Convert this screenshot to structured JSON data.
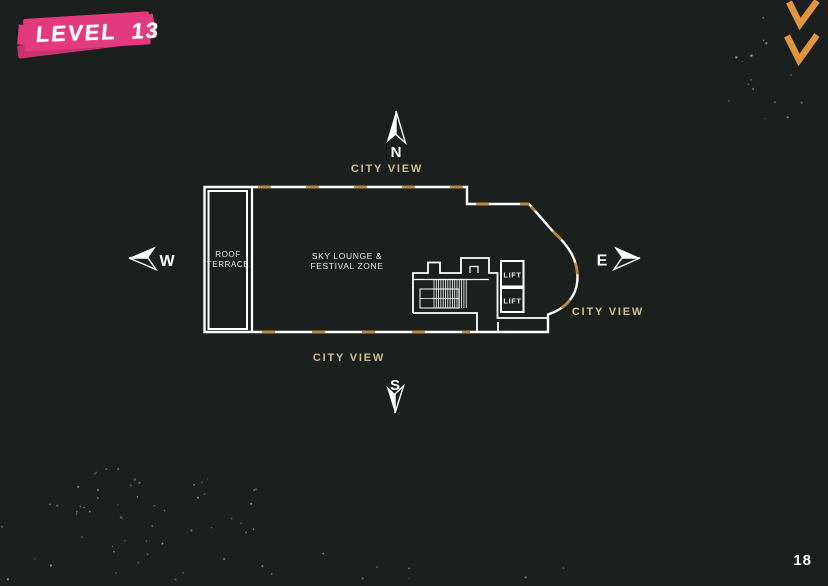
{
  "title": {
    "label": "LEVEL 13"
  },
  "page_number": "18",
  "compass": {
    "north": "N",
    "south": "S",
    "east": "E",
    "west": "W"
  },
  "views": {
    "city_view_top": "CITY VIEW",
    "city_view_bottom": "CITY VIEW",
    "city_view_right": "CITY VIEW"
  },
  "plan": {
    "roof_terrace_line1": "ROOF",
    "roof_terrace_line2": "TERRACE",
    "zone_line1": "SKY LOUNGE &",
    "zone_line2": "FESTIVAL ZONE",
    "lift_upper": "LIFT",
    "lift_lower": "LIFT"
  },
  "colors": {
    "background": "#1b201e",
    "plan_line": "#ffffff",
    "view_label": "#cfc08a",
    "window_dash": "#bd8a3a",
    "chevron": "#e0953e",
    "badge_pink": "#e23a7d",
    "badge_pink_dark": "#c9326e"
  }
}
